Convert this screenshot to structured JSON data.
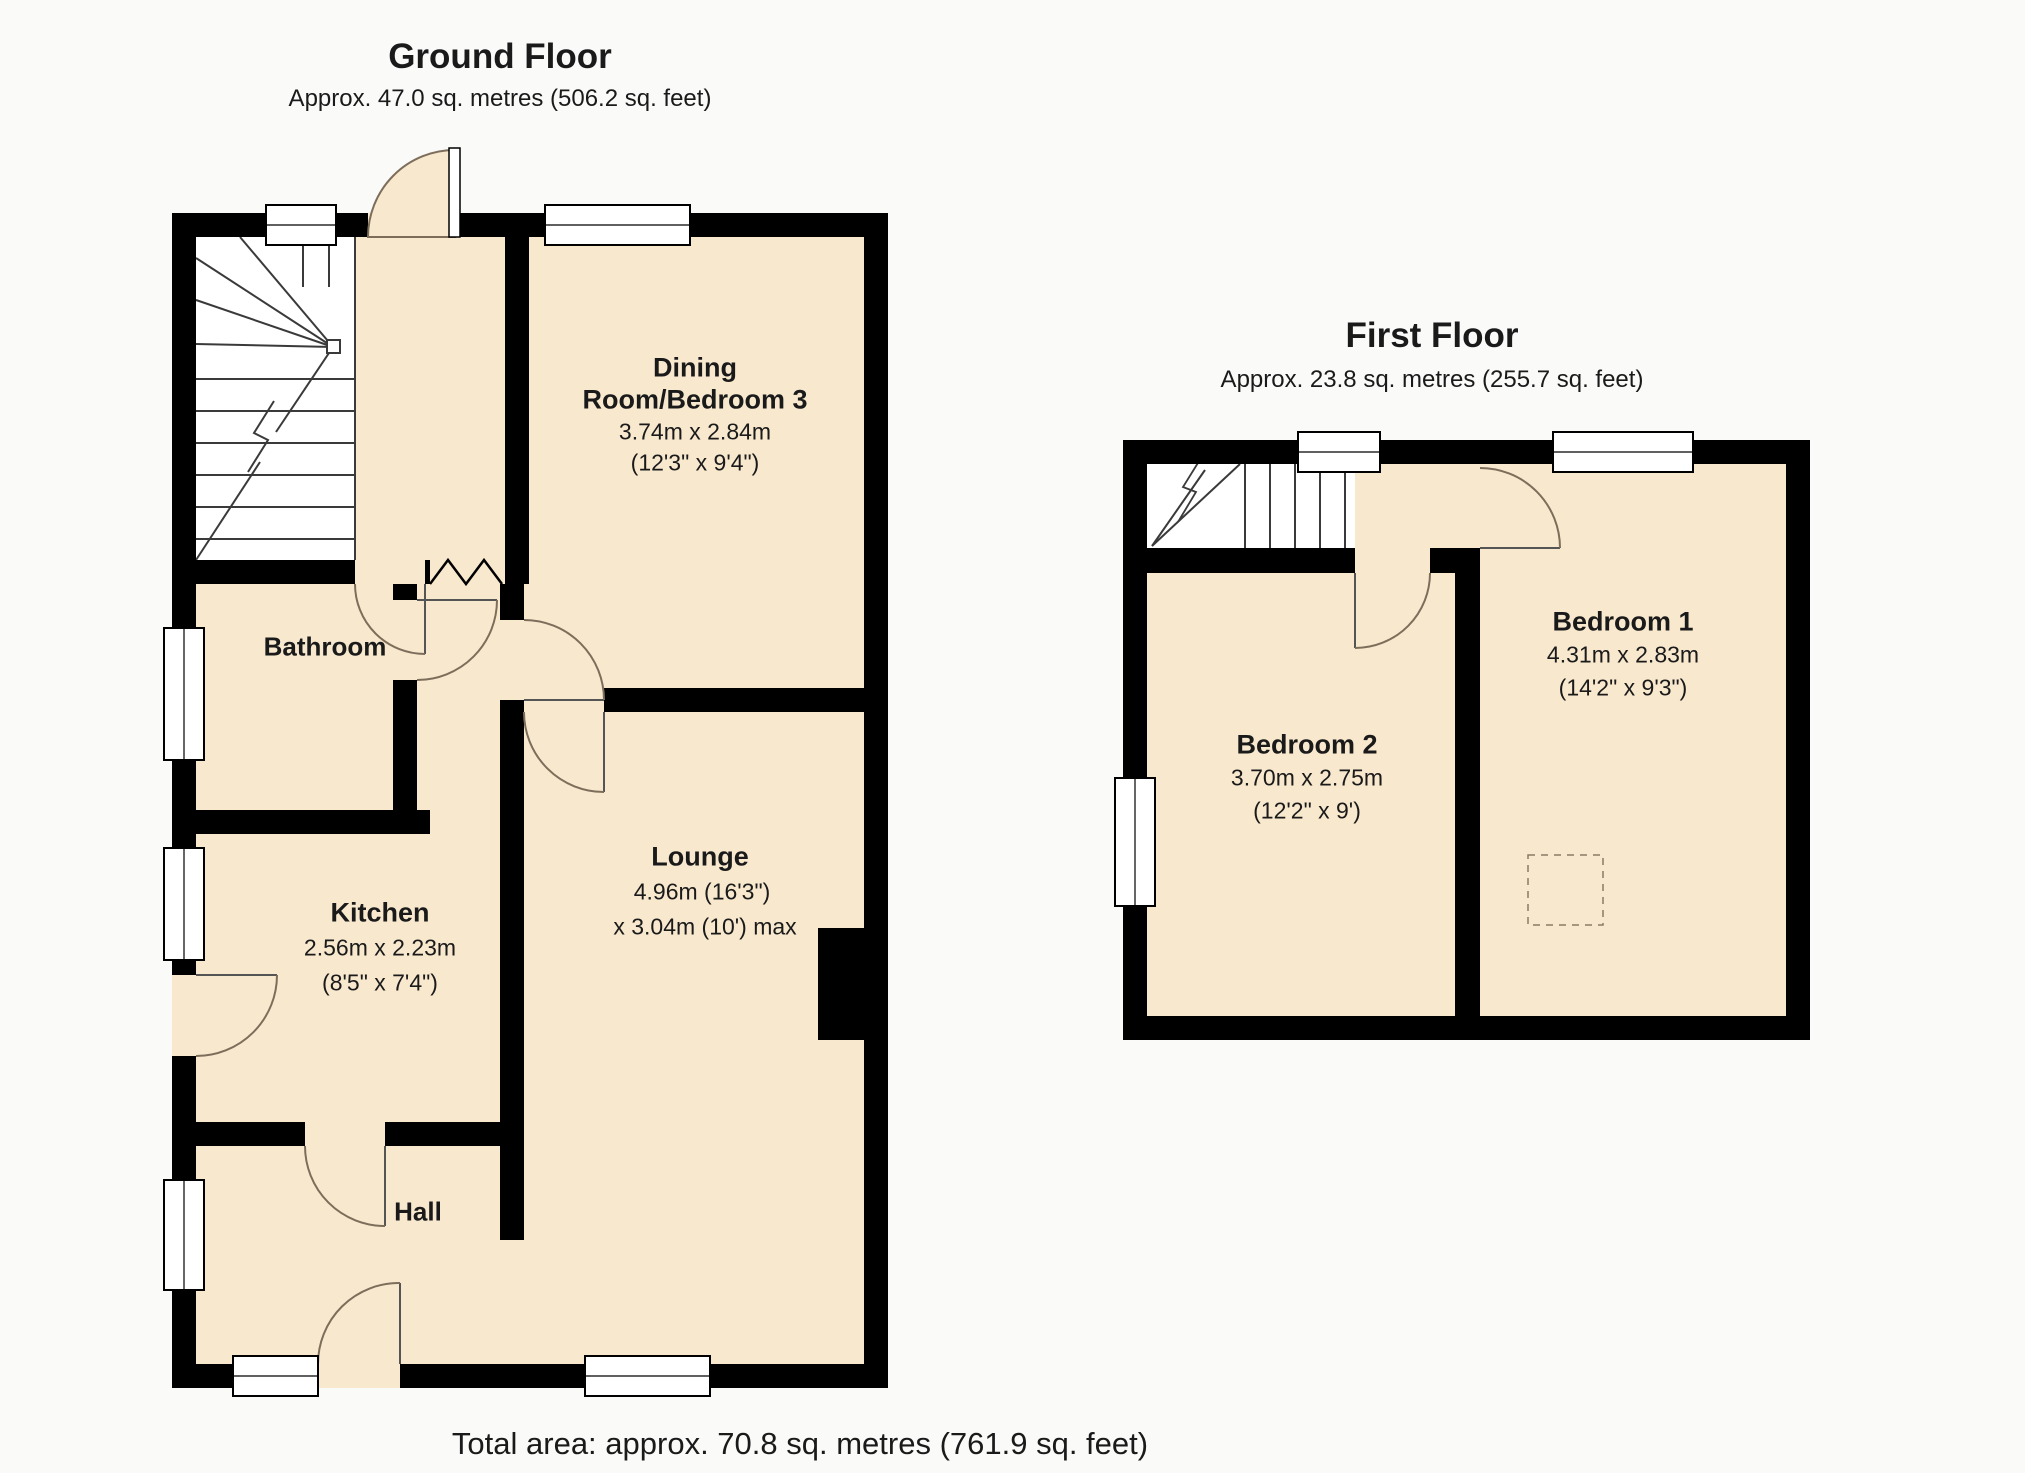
{
  "colors": {
    "background": "#fafaf9",
    "floor_fill": "#f8e8ce",
    "wall": "#000000",
    "door_arc": "#7d6e5c",
    "stair_line": "#3a3a3a",
    "text": "#1a1a1a"
  },
  "ground_floor": {
    "title": "Ground Floor",
    "subtitle": "Approx. 47.0 sq. metres (506.2 sq. feet)",
    "rooms": {
      "dining": {
        "name_line1": "Dining",
        "name_line2": "Room/Bedroom 3",
        "size_metric": "3.74m x 2.84m",
        "size_imperial": "(12'3\" x 9'4\")"
      },
      "bathroom": {
        "name": "Bathroom"
      },
      "kitchen": {
        "name": "Kitchen",
        "size_metric": "2.56m x 2.23m",
        "size_imperial": "(8'5\" x 7'4\")"
      },
      "lounge": {
        "name": "Lounge",
        "size_line1": "4.96m (16'3\")",
        "size_line2": "x 3.04m (10') max"
      },
      "hall": {
        "name": "Hall"
      }
    }
  },
  "first_floor": {
    "title": "First Floor",
    "subtitle": "Approx. 23.8 sq. metres (255.7 sq. feet)",
    "rooms": {
      "bedroom1": {
        "name": "Bedroom 1",
        "size_metric": "4.31m x 2.83m",
        "size_imperial": "(14'2\" x 9'3\")"
      },
      "bedroom2": {
        "name": "Bedroom 2",
        "size_metric": "3.70m x 2.75m",
        "size_imperial": "(12'2\" x 9')"
      }
    }
  },
  "footer": {
    "total_area": "Total area: approx. 70.8 sq. metres (761.9 sq. feet)"
  }
}
